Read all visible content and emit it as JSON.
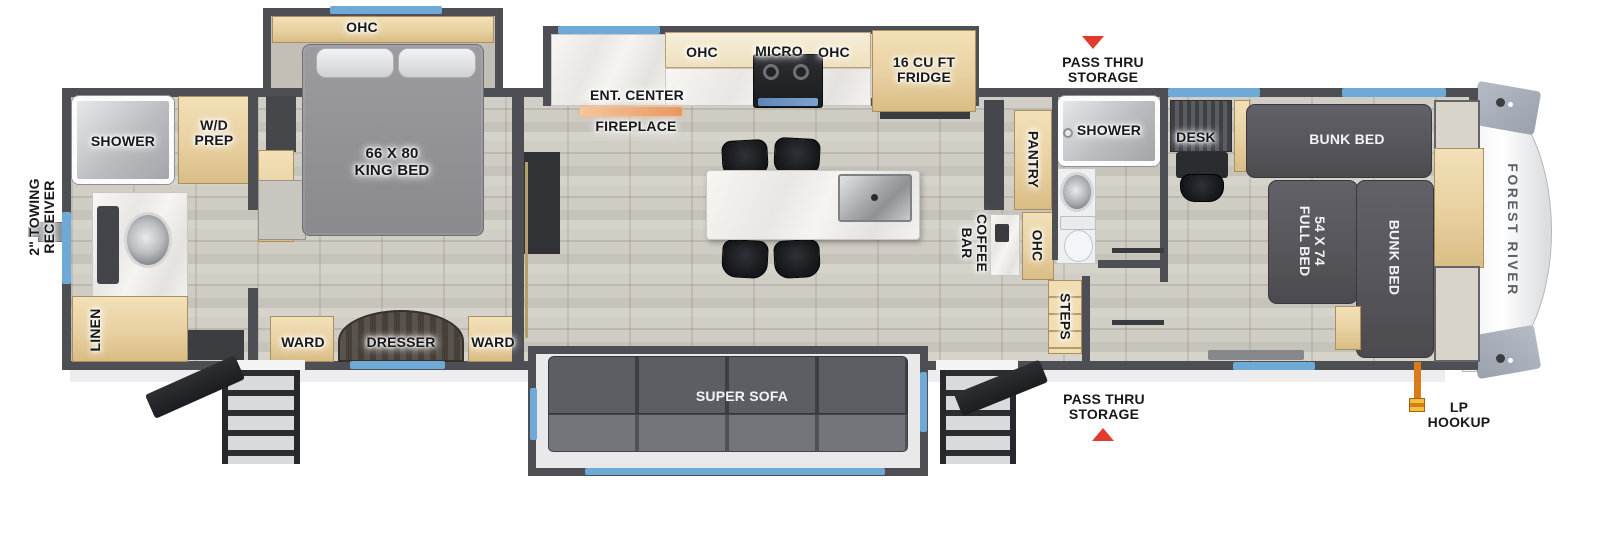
{
  "plan": {
    "brand": "FOREST RIVER",
    "labels": {
      "towing_receiver": "2\" TOWING\nRECEIVER",
      "rear_shower": "SHOWER",
      "wd_prep": "W/D\nPREP",
      "linen": "LINEN",
      "bedroom_ohc": "OHC",
      "king_bed": "66 X 80\nKING BED",
      "ward_left": "WARD",
      "dresser": "DRESSER",
      "ward_right": "WARD",
      "ent_center": "ENT. CENTER",
      "fireplace": "FIREPLACE",
      "kitchen_ohc_left": "OHC",
      "micro": "MICRO",
      "kitchen_ohc_right": "OHC",
      "fridge": "16 CU FT\nFRIDGE",
      "pass_thru_top": "PASS THRU\nSTORAGE",
      "pantry": "PANTRY",
      "mid_shower": "SHOWER",
      "coffee_bar": "COFFEE\nBAR",
      "mid_ohc": "OHC",
      "steps": "STEPS",
      "desk": "DESK",
      "bunk_bed_top": "BUNK BED",
      "full_bed": "54 X 74\nFULL BED",
      "bunk_bed_right": "BUNK BED",
      "super_sofa": "SUPER SOFA",
      "pass_thru_bottom": "PASS THRU\nSTORAGE",
      "lp_hookup": "LP\nHOOKUP"
    },
    "colors": {
      "wall": "#4e4f54",
      "window_accent": "#6fa9d6",
      "wood_cabinet": "#e8d0a0",
      "dark_furniture": "#55555a",
      "arrow_red": "#e23b2e",
      "fireplace_orange": "#f0a876",
      "lp_orange": "#d97a1d",
      "floor": "#cbc8c0"
    }
  }
}
